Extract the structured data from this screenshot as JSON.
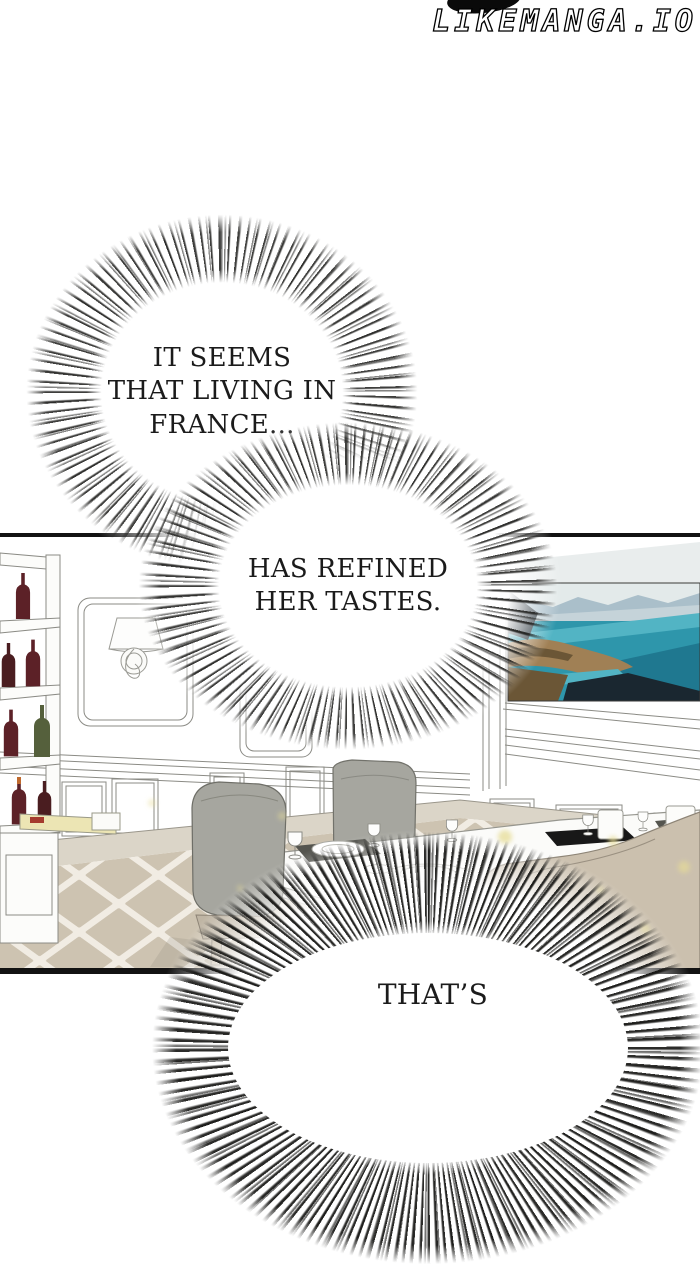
{
  "watermark": {
    "site_text": "LIKEMANGA.IO"
  },
  "bubbles": {
    "first": {
      "text": "IT SEEMS\nTHAT LIVING IN\nFRANCE..."
    },
    "second": {
      "text": "HAS REFINED\nHER TASTES."
    },
    "third": {
      "text": "THAT’S"
    }
  },
  "palette": {
    "ink": "#121212",
    "wall_white": "#ffffff",
    "ceiling_shade": "#e9eded",
    "chair_gray": "#a6a69f",
    "chair_tan": "#cbc0ae",
    "seat_tan": "#bfb5a4",
    "leg_wood": "#c3b8a3",
    "table_white": "#fbfbf9",
    "table_edge": "#ecebe7",
    "placemat_dark": "#55554f",
    "tablet_black": "#181818",
    "baseboard": "#dbd5c8",
    "tile": "#cdc3b1",
    "grout": "#f1ece3",
    "tray_yellow": "#ece5b4",
    "tray_item_red": "#a43b2e",
    "bottle_red": "#5c2127",
    "bottle_maroon": "#4a1d20",
    "bottle_olive": "#55603c",
    "bottle_cap_orange": "#c06a2e",
    "sparkle": "#e6dc96",
    "painting": {
      "sky": "#e3eaea",
      "mountain_far": "#aabfca",
      "mountain_mid": "#c5d3d9",
      "sea": "#2e96ab",
      "sea_light": "#52b4c4",
      "sea_dark": "#1f7890",
      "land_tan": "#a08055",
      "land_dark": "#6b5636",
      "shadow_dark": "#1a2730"
    }
  }
}
